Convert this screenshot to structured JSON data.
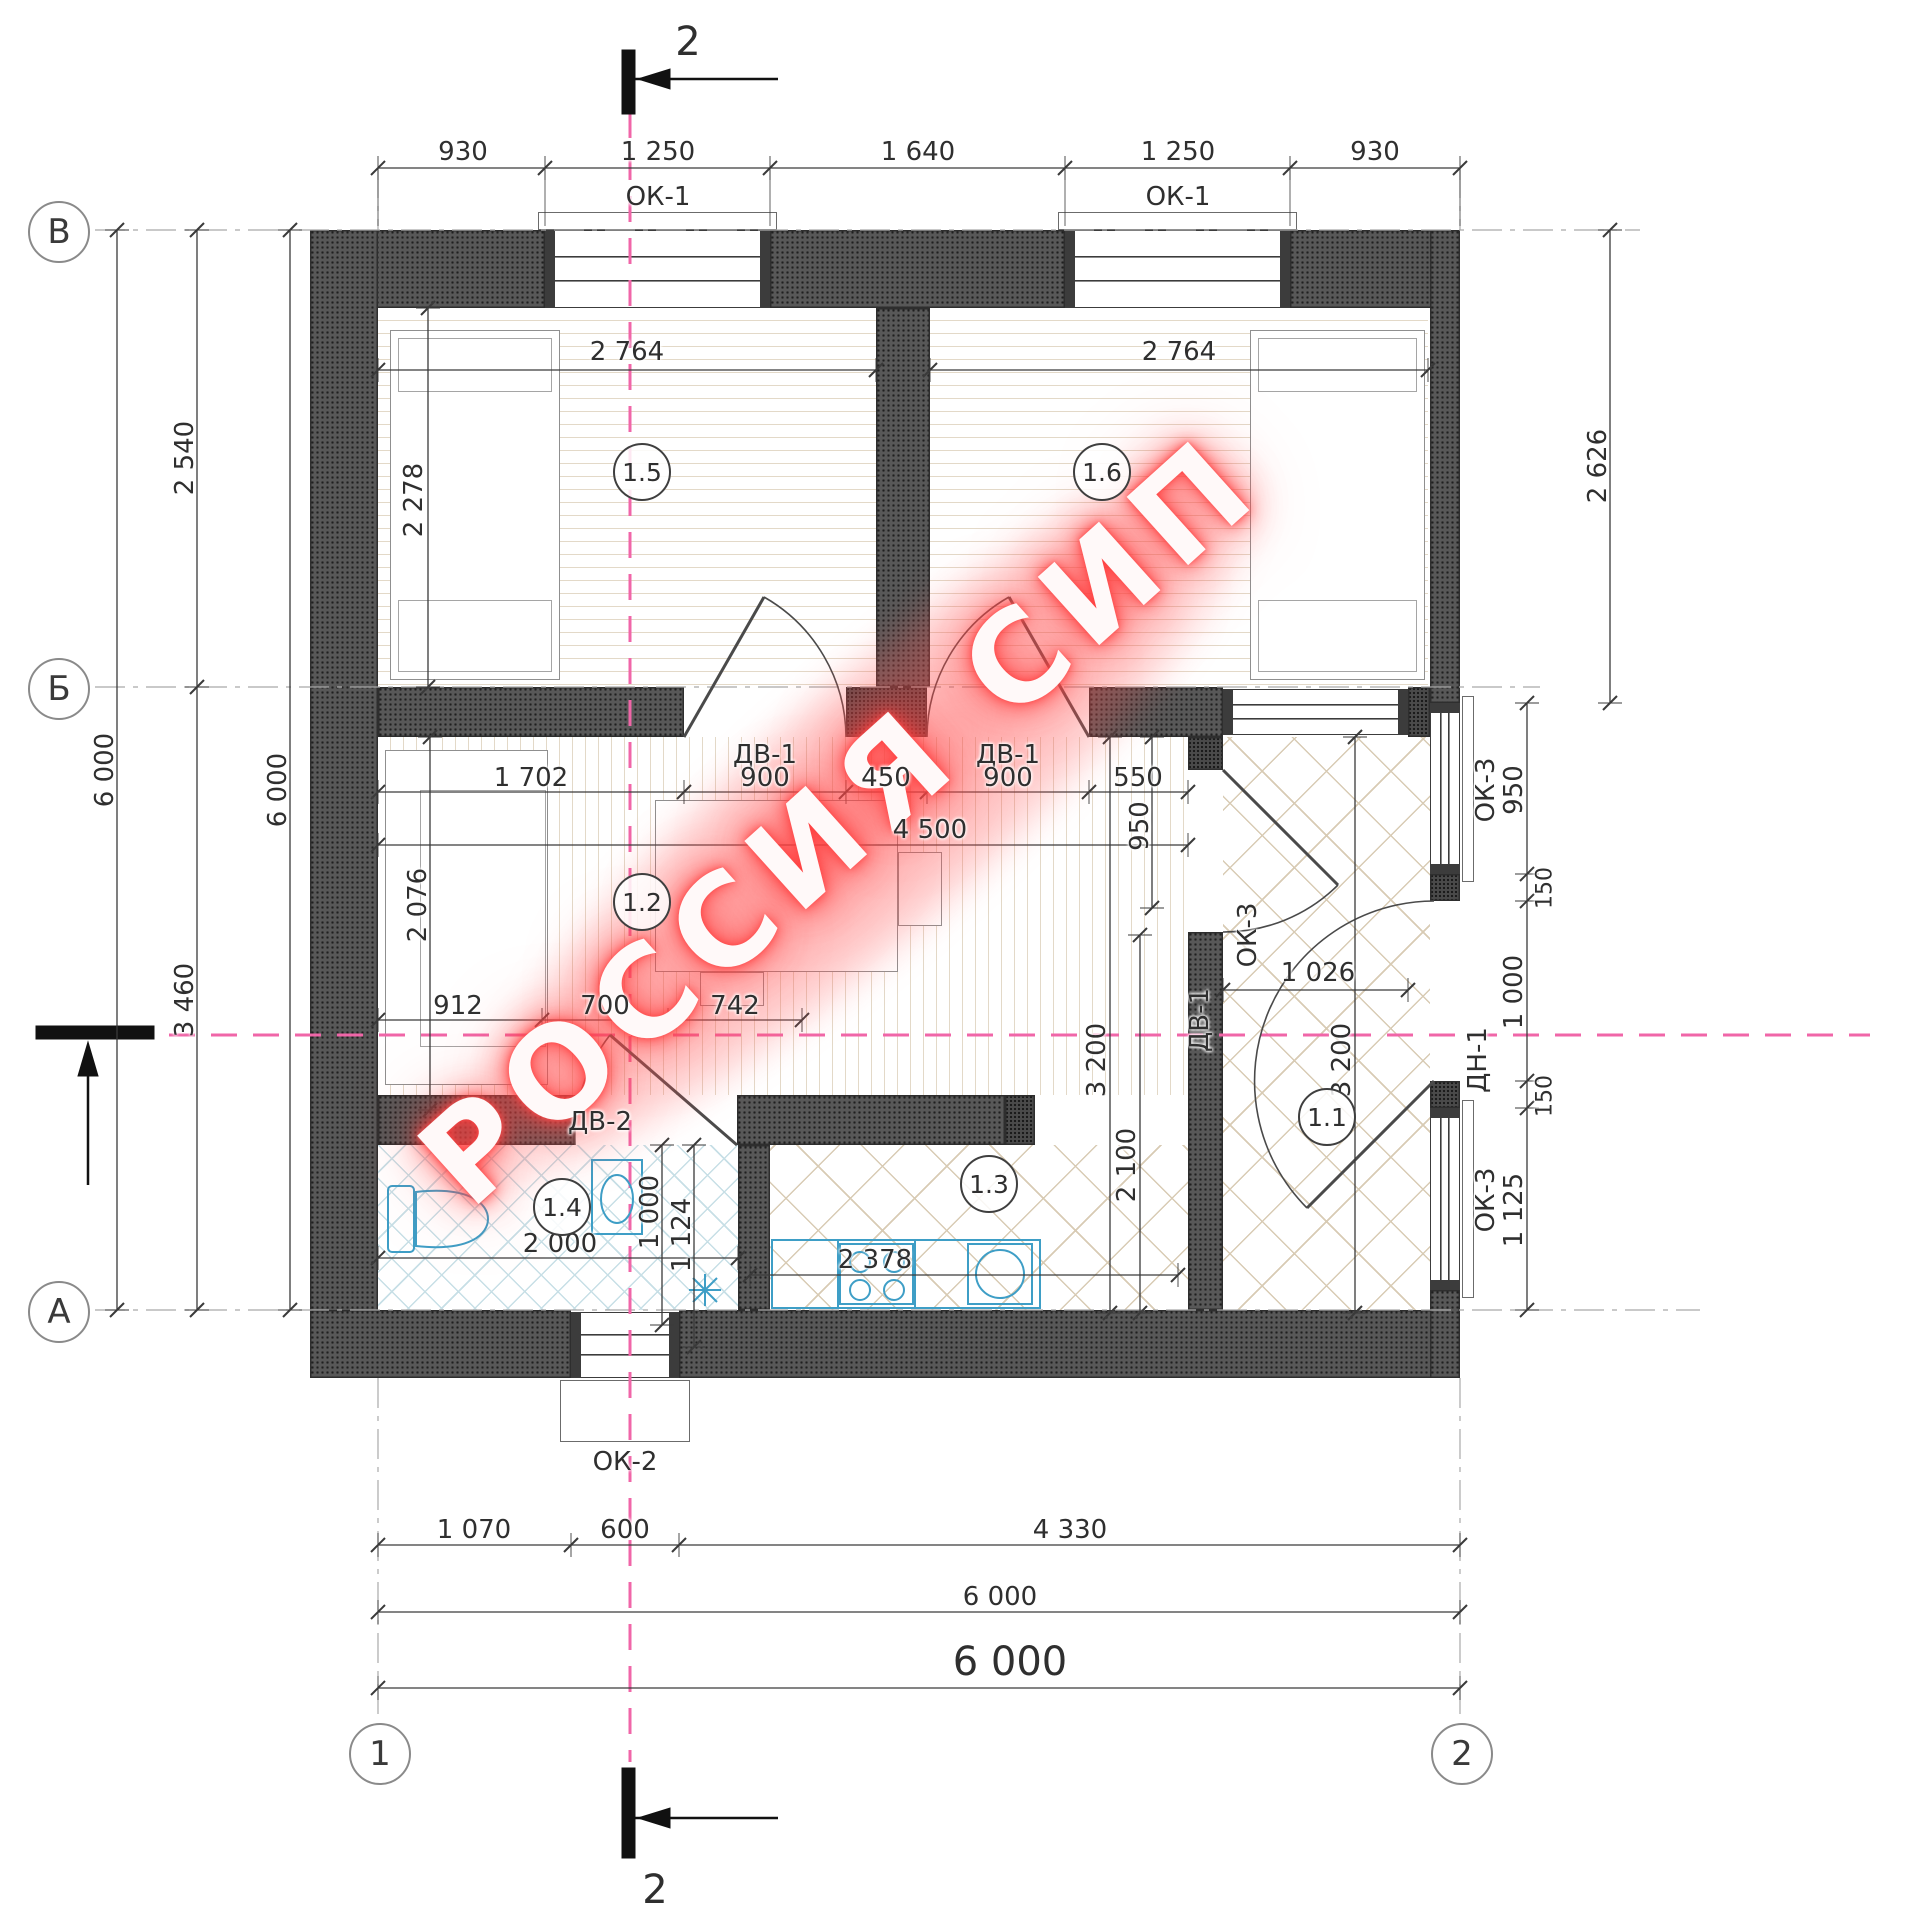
{
  "watermark": {
    "text": "РОССИЯ СИП"
  },
  "colors": {
    "wall": "#4b4b4b",
    "line": "#3a3a3a",
    "pink": "#f066a8",
    "blue": "#3e9ec6",
    "floorWood": "#e3d9c8",
    "floorTile": "#c7dfe6",
    "floorBeige": "#d8cbb4",
    "watermarkGlow": "#ff4d4d"
  },
  "axis_markers": [
    {
      "label": "В",
      "x": 57,
      "y": 230
    },
    {
      "label": "Б",
      "x": 57,
      "y": 687
    },
    {
      "label": "А",
      "x": 57,
      "y": 1310
    },
    {
      "label": "1",
      "x": 378,
      "y": 1752
    },
    {
      "label": "2",
      "x": 1460,
      "y": 1752
    }
  ],
  "room_markers": [
    {
      "label": "1.5",
      "x": 640,
      "y": 470
    },
    {
      "label": "1.6",
      "x": 1100,
      "y": 470
    },
    {
      "label": "1.2",
      "x": 640,
      "y": 900
    },
    {
      "label": "1.4",
      "x": 560,
      "y": 1205
    },
    {
      "label": "1.3",
      "x": 987,
      "y": 1182
    },
    {
      "label": "1.1",
      "x": 1325,
      "y": 1115
    }
  ],
  "section_marks": [
    {
      "t": "2",
      "x": 688,
      "y": 42,
      "s": 40
    },
    {
      "t": "2",
      "x": 655,
      "y": 1890,
      "s": 40
    }
  ],
  "labels": [
    {
      "t": "930",
      "x": 463,
      "y": 152
    },
    {
      "t": "1 250",
      "x": 658,
      "y": 152
    },
    {
      "t": "1 640",
      "x": 918,
      "y": 152
    },
    {
      "t": "1 250",
      "x": 1178,
      "y": 152
    },
    {
      "t": "930",
      "x": 1375,
      "y": 152
    },
    {
      "t": "ОК-1",
      "x": 658,
      "y": 197
    },
    {
      "t": "ОК-1",
      "x": 1178,
      "y": 197
    },
    {
      "t": "6 000",
      "x": 105,
      "y": 770,
      "r": -90
    },
    {
      "t": "2 540",
      "x": 185,
      "y": 458,
      "r": -90
    },
    {
      "t": "3 460",
      "x": 185,
      "y": 1000,
      "r": -90
    },
    {
      "t": "6 000",
      "x": 278,
      "y": 790,
      "r": -90
    },
    {
      "t": "2 764",
      "x": 627,
      "y": 352
    },
    {
      "t": "2 764",
      "x": 1179,
      "y": 352
    },
    {
      "t": "2 278",
      "x": 414,
      "y": 500,
      "r": -90
    },
    {
      "t": "2 626",
      "x": 1598,
      "y": 466,
      "r": -90
    },
    {
      "t": "ДВ-1",
      "x": 765,
      "y": 755
    },
    {
      "t": "ДВ-1",
      "x": 1008,
      "y": 755
    },
    {
      "t": "1 702",
      "x": 531,
      "y": 778
    },
    {
      "t": "900",
      "x": 765,
      "y": 778
    },
    {
      "t": "450",
      "x": 886,
      "y": 778
    },
    {
      "t": "900",
      "x": 1008,
      "y": 778
    },
    {
      "t": "550",
      "x": 1138,
      "y": 778
    },
    {
      "t": "950",
      "x": 1140,
      "y": 826,
      "r": -90
    },
    {
      "t": "4 500",
      "x": 930,
      "y": 830
    },
    {
      "t": "ОК-3",
      "x": 1248,
      "y": 935,
      "r": -90
    },
    {
      "t": "1 026",
      "x": 1318,
      "y": 973
    },
    {
      "t": "2 076",
      "x": 418,
      "y": 905,
      "r": -90
    },
    {
      "t": "912",
      "x": 458,
      "y": 1006
    },
    {
      "t": "700",
      "x": 605,
      "y": 1006
    },
    {
      "t": "742",
      "x": 735,
      "y": 1006
    },
    {
      "t": "ДВ-2",
      "x": 600,
      "y": 1122
    },
    {
      "t": "1 000",
      "x": 650,
      "y": 1212,
      "r": -90
    },
    {
      "t": "2 000",
      "x": 560,
      "y": 1244
    },
    {
      "t": "1 124",
      "x": 682,
      "y": 1235,
      "r": -90
    },
    {
      "t": "2 378",
      "x": 875,
      "y": 1260
    },
    {
      "t": "2 100",
      "x": 1127,
      "y": 1165,
      "r": -90
    },
    {
      "t": "3 200",
      "x": 1097,
      "y": 1060,
      "r": -90
    },
    {
      "t": "3 200",
      "x": 1342,
      "y": 1060,
      "r": -90
    },
    {
      "t": "ДВ-1",
      "x": 1200,
      "y": 1020,
      "r": -90
    },
    {
      "t": "950",
      "x": 1514,
      "y": 790,
      "r": -90
    },
    {
      "t": "150",
      "x": 1545,
      "y": 888,
      "r": -90,
      "s": 22
    },
    {
      "t": "1 000",
      "x": 1514,
      "y": 992,
      "r": -90
    },
    {
      "t": "150",
      "x": 1545,
      "y": 1096,
      "r": -90,
      "s": 22
    },
    {
      "t": "1 125",
      "x": 1514,
      "y": 1210,
      "r": -90
    },
    {
      "t": "ДН-1",
      "x": 1478,
      "y": 1060,
      "r": -90
    },
    {
      "t": "ОК-3",
      "x": 1486,
      "y": 790,
      "r": -90
    },
    {
      "t": "ОК-3",
      "x": 1486,
      "y": 1200,
      "r": -90
    },
    {
      "t": "ОК-2",
      "x": 625,
      "y": 1462
    },
    {
      "t": "1 070",
      "x": 474,
      "y": 1530
    },
    {
      "t": "600",
      "x": 625,
      "y": 1530
    },
    {
      "t": "4 330",
      "x": 1070,
      "y": 1530
    },
    {
      "t": "6 000",
      "x": 1000,
      "y": 1597
    },
    {
      "t": "6 000",
      "x": 1010,
      "y": 1662,
      "s": 40
    }
  ]
}
